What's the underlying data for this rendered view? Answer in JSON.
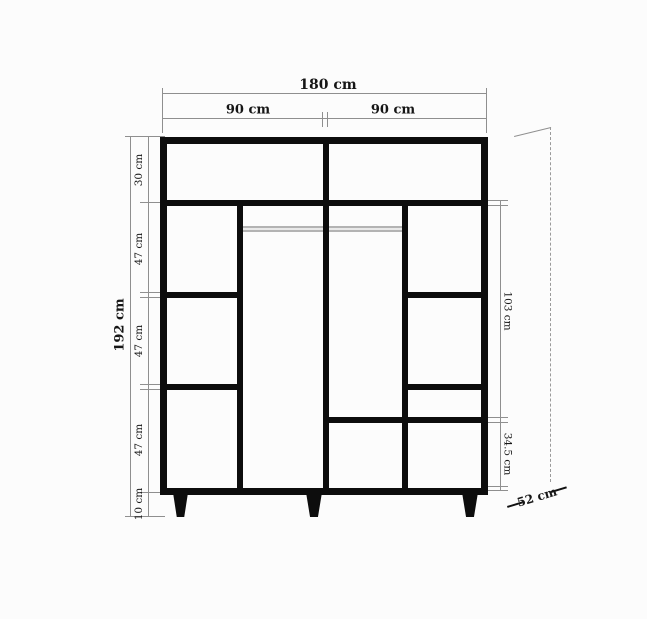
{
  "diagram": {
    "subject": "wardrobe-dimension-drawing",
    "labels": {
      "width_total": "180 cm",
      "width_left": "90 cm",
      "width_right": "90 cm",
      "height_total": "192 cm",
      "segments_left": {
        "top": "30 cm",
        "upper": "47 cm",
        "middle": "47 cm",
        "lower": "47 cm",
        "legs": "10 cm"
      },
      "segments_right": {
        "hanging": "103 cm",
        "bottom": "34.5 cm"
      },
      "depth": "52 cm"
    },
    "colors": {
      "structure": "#0d0d0d",
      "dimension_line": "#8f8f8f",
      "rail": "#b3b3b3",
      "background": "#fcfcfc",
      "text": "#161616"
    }
  }
}
